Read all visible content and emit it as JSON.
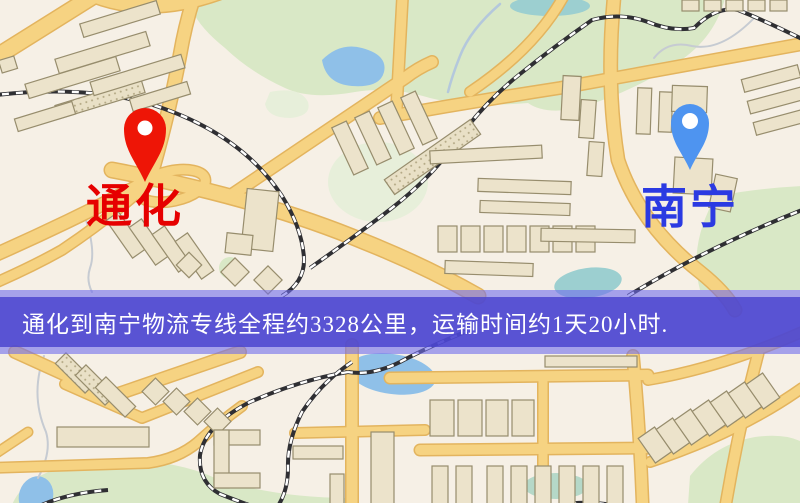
{
  "banner": {
    "text": "通化到南宁物流专线全程约3328公里，运输时间约1天20小时."
  },
  "map": {
    "origin": {
      "name": "通化"
    },
    "destination": {
      "name": "南宁"
    }
  },
  "theme": {
    "map_bg": "#f6f0e6",
    "road_fill": "#f6d382",
    "road_casing": "#e3b45e",
    "building_fill": "#ece3cb",
    "building_stroke": "#978d6d",
    "park_green": "#d9e8c6",
    "water_blue": "#8fc0e8",
    "rail_dark": "#2f2f33",
    "banner_core": "rgba(72,66,206,0.82)",
    "banner_edge": "rgba(112,108,236,0.6)",
    "banner_text": "#ffffff",
    "origin_pin": "#ee1506",
    "origin_label": "#e60000",
    "dest_pin": "#4e94f0",
    "dest_label": "#2b3ae2"
  }
}
